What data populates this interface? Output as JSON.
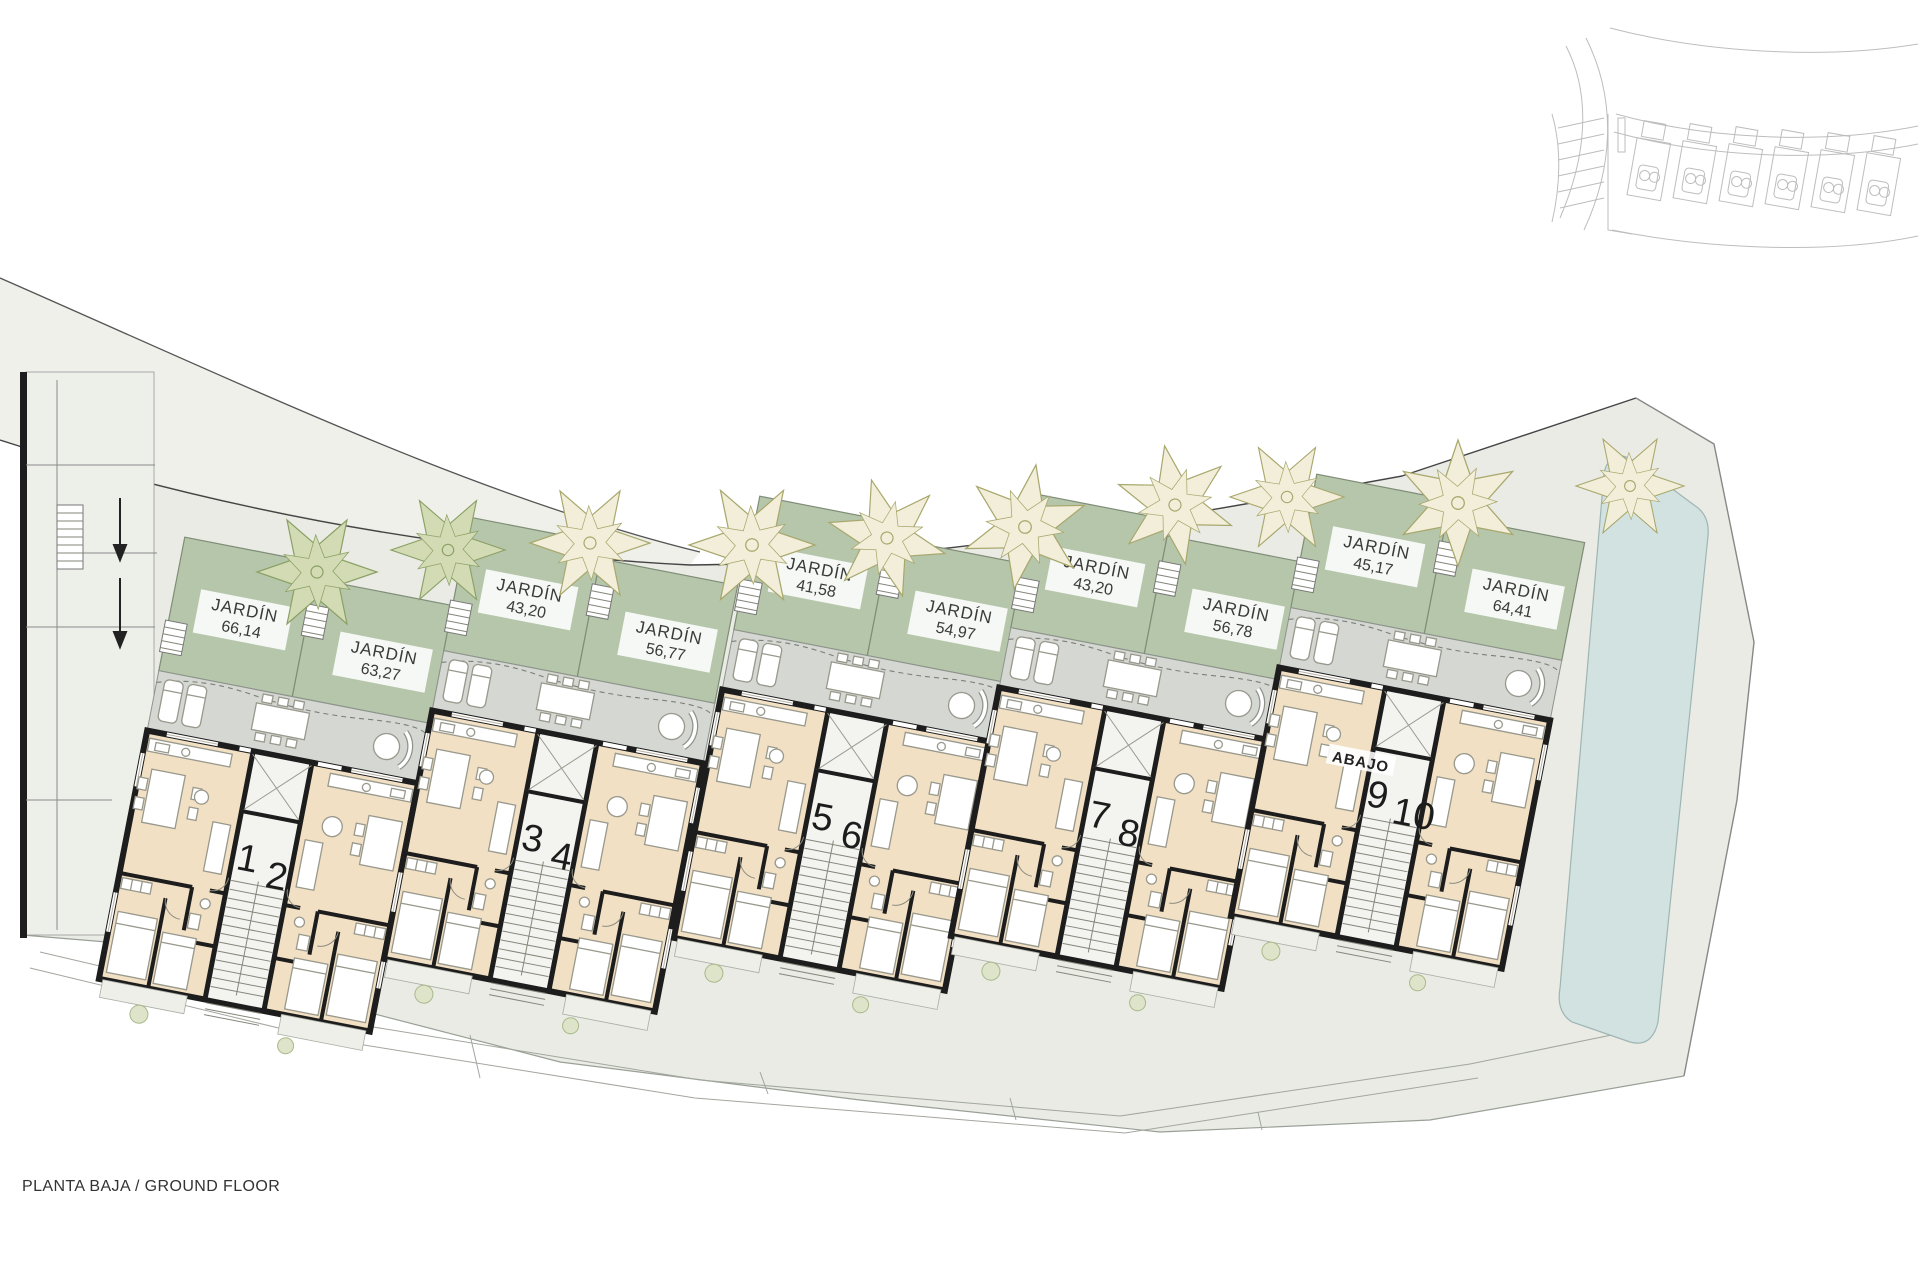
{
  "plan": {
    "title": "PLANTA BAJA / GROUND FLOOR",
    "abajo_label": "ABAJO",
    "units": [
      "1",
      "2",
      "3",
      "4",
      "5",
      "6",
      "7",
      "8",
      "9",
      "10"
    ],
    "gardens": [
      {
        "label": "JARDÍN",
        "area": "66,14"
      },
      {
        "label": "JARDÍN",
        "area": "63,27"
      },
      {
        "label": "JARDÍN",
        "area": "43,20"
      },
      {
        "label": "JARDÍN",
        "area": "56,77"
      },
      {
        "label": "JARDÍN",
        "area": "41,58"
      },
      {
        "label": "JARDÍN",
        "area": "54,97"
      },
      {
        "label": "JARDÍN",
        "area": "43,20"
      },
      {
        "label": "JARDÍN",
        "area": "56,78"
      },
      {
        "label": "JARDÍN",
        "area": "45,17"
      },
      {
        "label": "JARDÍN",
        "area": "64,41"
      }
    ],
    "colors": {
      "garden_green": "#b6c6ab",
      "terrace_gray": "#d4d7d2",
      "interior_beige": "#f2e0c4",
      "wall_black": "#1d1d1d",
      "pool_blue": "#d2e2e1",
      "ground": "#e9ebe4",
      "road": "#eff0ea",
      "tree_cream": "#f3eeda",
      "tree_green": "#d3dbb4"
    }
  }
}
